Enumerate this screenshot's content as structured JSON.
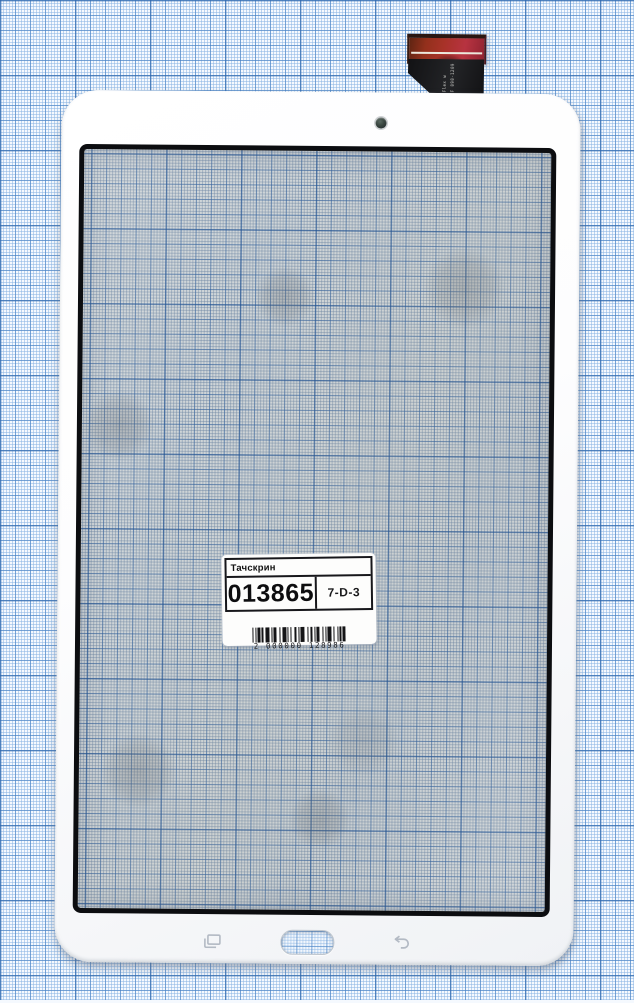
{
  "label": {
    "title": "Тачскрин",
    "code": "013865",
    "bin": "7-D-3",
    "barcode_text": "2 000000 128986",
    "barcode_bars": [
      1,
      1,
      1,
      1,
      2,
      1,
      1,
      2,
      3,
      1,
      1,
      1,
      2,
      2,
      1,
      1,
      3,
      1,
      1,
      1,
      1,
      2,
      2,
      1,
      1,
      1,
      3,
      2,
      1,
      1,
      2,
      1,
      1,
      1,
      2,
      2,
      1,
      1,
      1,
      1,
      3,
      1,
      1,
      2,
      1,
      1,
      1,
      1,
      2,
      1
    ]
  },
  "flex": {
    "marking_line1": "Φ-Flex w",
    "marking_line2": "DCF 090-1209"
  },
  "icons": {
    "camera": "front-camera-hole",
    "recents": "recent-apps-icon",
    "home": "home-button-cutout",
    "back": "back-arrow-icon"
  },
  "colors": {
    "paper_line_blue": "#4f86c4",
    "frame_white": "#fbfcfd",
    "screen_border_black": "#0c0d10",
    "connector_red": "#a83228",
    "barcode_black": "#141416"
  }
}
